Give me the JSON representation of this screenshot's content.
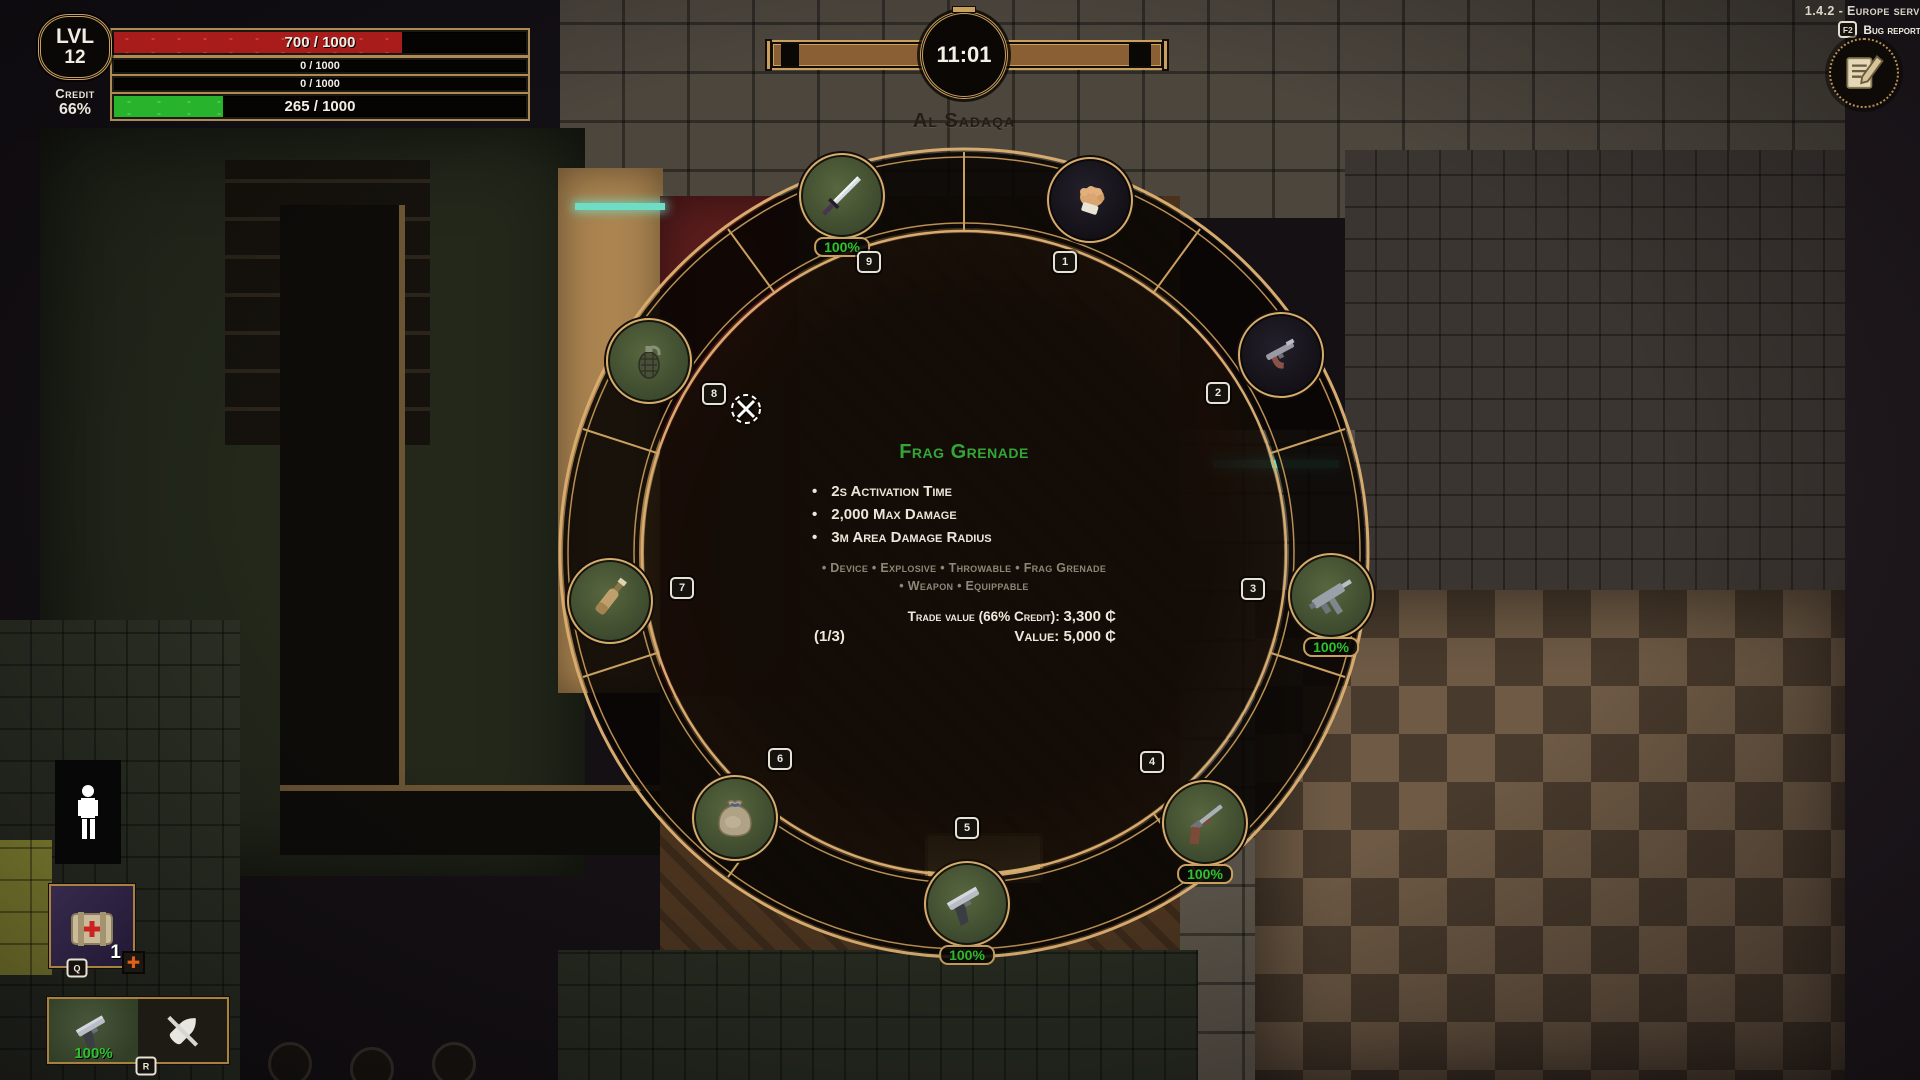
{
  "hud": {
    "level_label": "LVL",
    "level_value": "12",
    "credit_label": "Credit",
    "credit_value": "66%",
    "bars": [
      {
        "name": "health",
        "label": "700 / 1000",
        "pct": 70,
        "color": "#a81c1c"
      },
      {
        "name": "shield",
        "label": "0 / 1000",
        "pct": 0,
        "color": "#000000"
      },
      {
        "name": "armor",
        "label": "0 / 1000",
        "pct": 0,
        "color": "#000000"
      },
      {
        "name": "stamina",
        "label": "265 / 1000",
        "pct": 26.5,
        "color": "#28b32c"
      }
    ]
  },
  "clock": {
    "time": "11:01"
  },
  "location": {
    "name": "Al Sadaqa"
  },
  "version": {
    "text": "1.4.2 - Europe serve",
    "bug_key": "F2",
    "bug_label": "Bug reporte"
  },
  "wheel": {
    "info": {
      "title": "Frag Grenade",
      "title_color": "#35a535",
      "stats": [
        "2s Activation Time",
        "2,000 Max Damage",
        "3m Area Damage Radius"
      ],
      "tags_line1": "• Device • Explosive • Throwable • Frag Grenade",
      "tags_line2": "• Weapon • Equippable",
      "trade_label": "Trade value (66% Credit):",
      "trade_value": "3,300 ₵",
      "stack": "(1/3)",
      "value_label": "Value:",
      "value": "5,000 ₵"
    },
    "slots": [
      {
        "key": "1",
        "item": "fists",
        "icon": "fist-icon",
        "condition": ""
      },
      {
        "key": "2",
        "item": "sawn-off pistol",
        "icon": "sawnoff-pistol-icon",
        "condition": ""
      },
      {
        "key": "3",
        "item": "smg",
        "icon": "smg-icon",
        "condition": "100%"
      },
      {
        "key": "4",
        "item": "shotgun",
        "icon": "shotgun-icon",
        "condition": "100%"
      },
      {
        "key": "5",
        "item": "pistol",
        "icon": "pistol-icon",
        "condition": "100%"
      },
      {
        "key": "6",
        "item": "sack",
        "icon": "sack-icon",
        "condition": ""
      },
      {
        "key": "7",
        "item": "bottle",
        "icon": "bottle-icon",
        "condition": ""
      },
      {
        "key": "8",
        "item": "frag grenade",
        "icon": "grenade-icon",
        "condition": ""
      },
      {
        "key": "9",
        "item": "katana",
        "icon": "katana-icon",
        "condition": "100%"
      }
    ]
  },
  "quickbar": {
    "medkit": {
      "count": "1",
      "key": "Q",
      "icon": "medkit-icon"
    },
    "weapon": {
      "condition": "100%",
      "key": "R",
      "icons": [
        "pistol-icon",
        "crossed-bullet-icon"
      ]
    }
  },
  "colors": {
    "gold_frame": "#caa05e",
    "condition_green": "#2ec22e",
    "title_green": "#35a535",
    "health_red": "#a81c1c",
    "stamina_green": "#28b32c",
    "timebar_brown": "#8a5f33"
  }
}
